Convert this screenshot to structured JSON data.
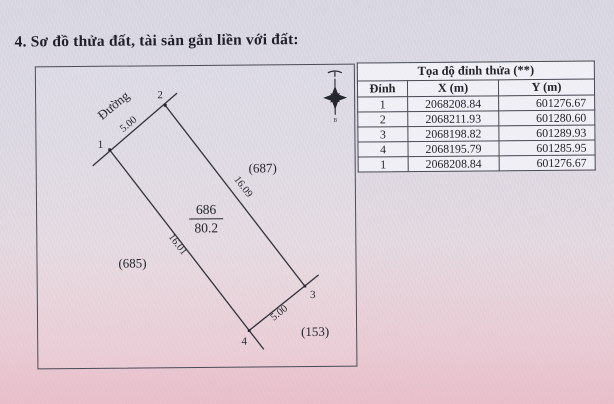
{
  "page": {
    "section_title": "4. Sơ đồ thửa đất, tài sản gắn liền với đất:"
  },
  "diagram": {
    "road_label": "Đường",
    "parcel": {
      "number": "686",
      "area": "80.2"
    },
    "vertex_labels": {
      "v1": "1",
      "v2": "2",
      "v3": "3",
      "v4": "4"
    },
    "dimensions": {
      "front": "5.00",
      "right_side": "16.09",
      "left_side": "16.01",
      "back": "5.00"
    },
    "neighbors": {
      "right": "(687)",
      "left": "(685)",
      "bottom_right": "(153)"
    },
    "north_arrow_letter": "B"
  },
  "table": {
    "title": "Tọa độ đỉnh thửa (**)",
    "columns": [
      "Đỉnh",
      "X (m)",
      "Y (m)"
    ],
    "rows": [
      [
        "1",
        "2068208.84",
        "601276.67"
      ],
      [
        "2",
        "2068211.93",
        "601280.60"
      ],
      [
        "3",
        "2068198.82",
        "601289.93"
      ],
      [
        "4",
        "2068195.79",
        "601285.95"
      ],
      [
        "1",
        "2068208.84",
        "601276.67"
      ]
    ]
  },
  "colors": {
    "paper": "#d9d8e2",
    "pattern_pink": "#dd9fb2",
    "ink": "#26262e",
    "border": "#4b4b56"
  }
}
